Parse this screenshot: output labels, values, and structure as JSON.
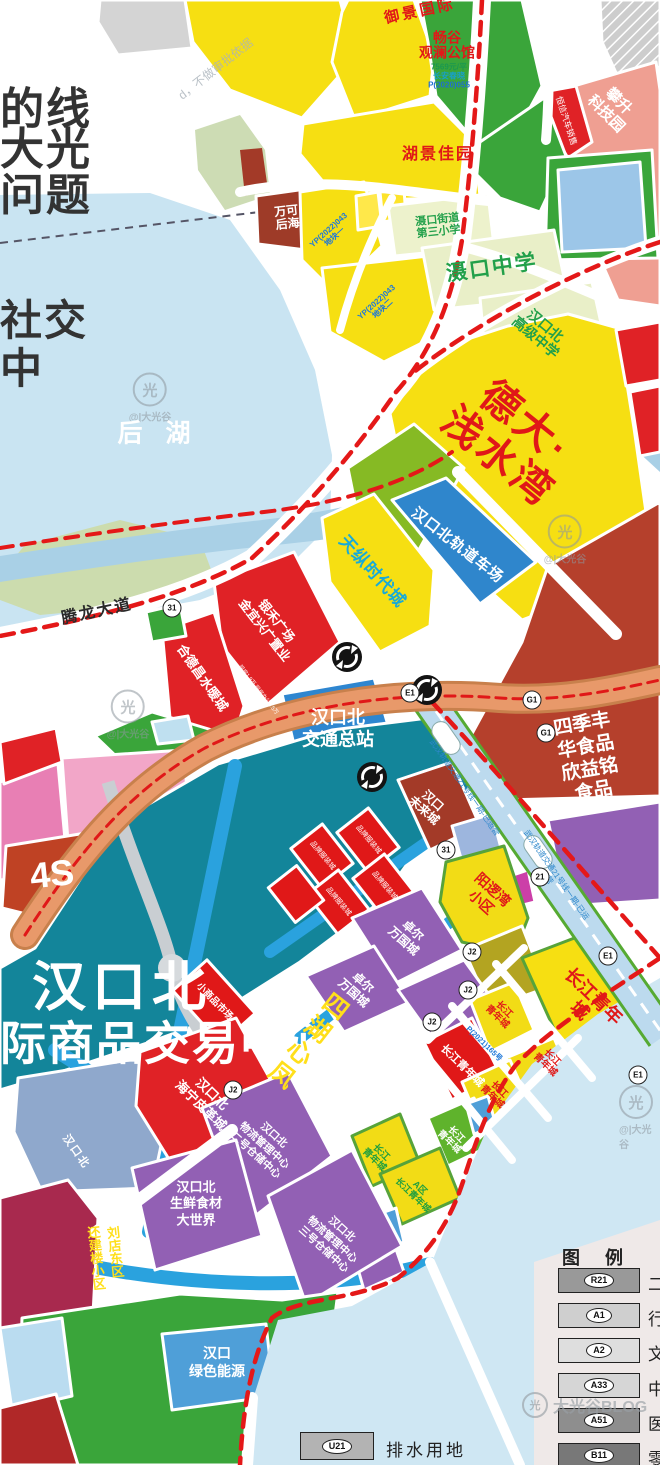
{
  "page": {
    "title": "汉口北规划图",
    "width": 660,
    "height": 1465
  },
  "overlay": {
    "l1": "的线",
    "l2": "大光",
    "l3": "问题",
    "l4": "社交",
    "l5": "中",
    "diag": "d，不做审批依据"
  },
  "watermark": {
    "logo": "@|大光谷",
    "blog": "大光谷BLOG",
    "logo_char": "光"
  },
  "palette": {
    "boundary_red": "#e41818",
    "water_lake": "#c9e4f2",
    "river": "#a9d0e6",
    "market_teal": "#13859a",
    "road_blue": "#2aa2de",
    "parcel_yellow": "#f6df12",
    "parcel_purple": "#9260b4",
    "parcel_red": "#e02226",
    "parcel_green": "#3aa53a",
    "expressway_tan": "#e8996a",
    "rail_band": "#bcdaee",
    "label_red": "#e01818",
    "label_green": "#22a04a",
    "label_blue": "#1f78d8",
    "dark_red": "#b5402c"
  },
  "map": {
    "labels": [
      {
        "name": "yujing-label",
        "text": "御景国际",
        "x": 420,
        "y": 12,
        "rot": -12,
        "fs": 15,
        "color": "#e01818",
        "w": 900,
        "ls": 3
      },
      {
        "name": "changgu-label",
        "text": "畅谷\n观澜公馆",
        "x": 447,
        "y": 46,
        "rot": 0,
        "fs": 14,
        "color": "#e01818",
        "w": 900
      },
      {
        "name": "changgu-price",
        "text": "7569元/平",
        "x": 449,
        "y": 68,
        "rot": 0,
        "fs": 8,
        "color": "#1a9850",
        "w": 700
      },
      {
        "name": "changgu-dev",
        "text": "长安春晓",
        "x": 449,
        "y": 77,
        "rot": 0,
        "fs": 8,
        "color": "#18a0c8",
        "w": 700
      },
      {
        "name": "changgu-code",
        "text": "P(2020)055",
        "x": 449,
        "y": 86,
        "rot": 0,
        "fs": 8,
        "color": "#1f6fd0",
        "w": 700
      },
      {
        "name": "hujing-label",
        "text": "湖景佳园",
        "x": 438,
        "y": 155,
        "rot": 0,
        "fs": 16,
        "color": "#e01818",
        "w": 900,
        "ls": 2
      },
      {
        "name": "keji-label",
        "text": "攀升\n科技园",
        "x": 612,
        "y": 108,
        "rot": 45,
        "fs": 15,
        "color": "#ffffff",
        "w": 700,
        "lh": 1.2
      },
      {
        "name": "hengxin-label",
        "text": "恒信汽车销售",
        "x": 566,
        "y": 121,
        "rot": 72,
        "fs": 8.5,
        "color": "#ffffff",
        "w": 400
      },
      {
        "name": "wanke-label",
        "text": "万可\n后海",
        "x": 287,
        "y": 218,
        "rot": -6,
        "fs": 12,
        "color": "#ffffff",
        "w": 700
      },
      {
        "name": "yp1-label",
        "text": "YP(2022)043\n地块一",
        "x": 332,
        "y": 234,
        "rot": -42,
        "fs": 8,
        "color": "#1f78d8",
        "w": 700
      },
      {
        "name": "yp2-label",
        "text": "YP(2022)043\n地块二",
        "x": 380,
        "y": 306,
        "rot": -42,
        "fs": 8,
        "color": "#1f78d8",
        "w": 700
      },
      {
        "name": "xiaoxue-label",
        "text": "滠口街道\n第三小学",
        "x": 438,
        "y": 226,
        "rot": -6,
        "fs": 11,
        "color": "#22a04a",
        "w": 900
      },
      {
        "name": "zhongxue-label",
        "text": "滠口中学",
        "x": 492,
        "y": 268,
        "rot": -8,
        "fs": 21,
        "color": "#22a04a",
        "w": 900,
        "ls": 2
      },
      {
        "name": "gaozhong-label",
        "text": "汉口北\n高级中学",
        "x": 540,
        "y": 332,
        "rot": 40,
        "fs": 14,
        "color": "#22a04a",
        "w": 900
      },
      {
        "name": "deda-label",
        "text": "德大·浅水湾",
        "x": 512,
        "y": 440,
        "rot": 39,
        "fs": 40,
        "color": "#e01818",
        "w": 900,
        "ls": 4
      },
      {
        "name": "guidao-label",
        "text": "汉口北轨道车场",
        "x": 457,
        "y": 546,
        "rot": 38,
        "fs": 15,
        "color": "#ffffff",
        "w": 700,
        "ls": 1
      },
      {
        "name": "tianzong-label",
        "text": "天纵时代城",
        "x": 372,
        "y": 572,
        "rot": 48,
        "fs": 17,
        "color": "#18aad8",
        "w": 900,
        "ls": 1
      },
      {
        "name": "houhu-label",
        "text": "后 湖",
        "x": 158,
        "y": 434,
        "rot": 0,
        "fs": 25,
        "color": "#ffffff",
        "w": 700,
        "ls": 8
      },
      {
        "name": "tenglong-label",
        "text": "腾龙大道",
        "x": 97,
        "y": 612,
        "rot": -12,
        "fs": 16,
        "color": "#2a2a2a",
        "w": 700,
        "ls": 2
      },
      {
        "name": "yinhe-label",
        "text": "银禾广场\n金宜兴广置业",
        "x": 270,
        "y": 626,
        "rot": 52,
        "fs": 12.5,
        "color": "#ffffff",
        "w": 700,
        "lh": 1.2
      },
      {
        "name": "yinhe-sub",
        "text": "现房1.9万 现房办公1.5万",
        "x": 258,
        "y": 690,
        "rot": 52,
        "fs": 5.5,
        "color": "#ffffff",
        "w": 400
      },
      {
        "name": "hedechang-label",
        "text": "合德昌水暖城",
        "x": 202,
        "y": 678,
        "rot": 55,
        "fs": 13,
        "color": "#ffffff",
        "w": 700
      },
      {
        "name": "jiaotong-label",
        "text": "汉口北\n交通总站",
        "x": 338,
        "y": 729,
        "rot": 0,
        "fs": 18,
        "color": "#ffffff",
        "w": 900,
        "lh": 1.2
      },
      {
        "name": "siji-label",
        "text": "四季丰华食品\n欣益铭食品",
        "x": 588,
        "y": 759,
        "rot": -10,
        "fs": 19,
        "color": "#ffffff",
        "w": 900,
        "lh": 1.2
      },
      {
        "name": "weilai-label",
        "text": "汉口\n未来城",
        "x": 428,
        "y": 806,
        "rot": 42,
        "fs": 12,
        "color": "#ffffff",
        "w": 700
      },
      {
        "name": "fours-label",
        "text": "4S",
        "x": 52,
        "y": 874,
        "rot": -6,
        "fs": 36,
        "color": "#ffffff",
        "w": 900
      },
      {
        "name": "hk-title-main",
        "text": "汉口北",
        "x": 122,
        "y": 988,
        "rot": 0,
        "fs": 54,
        "color": "#ffffff",
        "w": 900,
        "ls": 6
      },
      {
        "name": "hk-title-sub",
        "text": "际商品交易中心",
        "x": 168,
        "y": 1044,
        "rot": 0,
        "fs": 46,
        "color": "#ffffff",
        "w": 900,
        "ls": 2
      },
      {
        "name": "hall-label-1",
        "text": "品牌服装城",
        "x": 322,
        "y": 856,
        "rot": 50,
        "fs": 7,
        "color": "#ffffff",
        "w": 400
      },
      {
        "name": "hall-label-2",
        "text": "品牌服装城",
        "x": 368,
        "y": 840,
        "rot": 50,
        "fs": 7,
        "color": "#ffffff",
        "w": 400
      },
      {
        "name": "hall-label-3",
        "text": "品牌服装城",
        "x": 338,
        "y": 902,
        "rot": 50,
        "fs": 7,
        "color": "#ffffff",
        "w": 400
      },
      {
        "name": "hall-label-4",
        "text": "品牌服装城",
        "x": 384,
        "y": 886,
        "rot": 50,
        "fs": 7,
        "color": "#ffffff",
        "w": 400
      },
      {
        "name": "xiaoshangpin-label",
        "text": "小商品市场",
        "x": 214,
        "y": 1002,
        "rot": 46,
        "fs": 9.5,
        "color": "#ffffff",
        "w": 700
      },
      {
        "name": "pigecheng-label",
        "text": "汉口北\n海宁皮革城",
        "x": 206,
        "y": 1100,
        "rot": 44,
        "fs": 13,
        "color": "#ffffff",
        "w": 700,
        "lh": 1.25
      },
      {
        "name": "hkb-left-label",
        "text": "汉口北",
        "x": 76,
        "y": 1152,
        "rot": 55,
        "fs": 11,
        "color": "#ffffff",
        "w": 700,
        "ls": 2
      },
      {
        "name": "wuliu2-label",
        "text": "汉口北\n物流管理中心\n二号仓储中心",
        "x": 264,
        "y": 1146,
        "rot": 42,
        "fs": 10.5,
        "color": "#ffffff",
        "w": 700,
        "lh": 1.3
      },
      {
        "name": "wuliu3-label",
        "text": "汉口北\n物流管理中心\n三号仓储中心",
        "x": 332,
        "y": 1240,
        "rot": 42,
        "fs": 10.5,
        "color": "#ffffff",
        "w": 700,
        "lh": 1.3
      },
      {
        "name": "shengxian-label",
        "text": "汉口北\n生鲜食材\n大世界",
        "x": 196,
        "y": 1204,
        "rot": 0,
        "fs": 13,
        "color": "#ffffff",
        "w": 900,
        "lh": 1.25
      },
      {
        "name": "liudian-label-1",
        "text": "刘店东区",
        "x": 114,
        "y": 1252,
        "rot": -6,
        "fs": 13,
        "color": "#ffdf1a",
        "w": 900,
        "vert": true
      },
      {
        "name": "liudian-label-2",
        "text": "还建楼小区",
        "x": 95,
        "y": 1258,
        "rot": -6,
        "fs": 13,
        "color": "#ffdf1a",
        "w": 900,
        "vert": true
      },
      {
        "name": "lvse-label",
        "text": "汉口\n绿色能源",
        "x": 217,
        "y": 1362,
        "rot": 0,
        "fs": 14,
        "color": "#ffffff",
        "w": 700,
        "lh": 1.3
      },
      {
        "name": "yangluo-label",
        "text": "阳逻湾\n小区",
        "x": 487,
        "y": 896,
        "rot": 42,
        "fs": 14,
        "color": "#e01818",
        "w": 900,
        "lh": 1.2
      },
      {
        "name": "zhuoer-label-1",
        "text": "卓尔\n万国城",
        "x": 408,
        "y": 936,
        "rot": 42,
        "fs": 12,
        "color": "#ffffff",
        "w": 700,
        "lh": 1.2
      },
      {
        "name": "zhuoer-label-2",
        "text": "卓尔\n万国城",
        "x": 358,
        "y": 988,
        "rot": 42,
        "fs": 12,
        "color": "#ffffff",
        "w": 700,
        "lh": 1.2
      },
      {
        "name": "fenghuang-band-label",
        "text": "四湖心凤",
        "x": 306,
        "y": 1040,
        "rot": 38,
        "fs": 25,
        "color": "#ffdf1a",
        "w": 900,
        "ls": 4,
        "vert": true
      },
      {
        "name": "cj-big-label",
        "text": "长江青年城",
        "x": 586,
        "y": 1004,
        "rot": 44,
        "fs": 18,
        "color": "#e01818",
        "w": 900
      },
      {
        "name": "cj-label-red",
        "text": "长江青年城",
        "x": 462,
        "y": 1066,
        "rot": 44,
        "fs": 11,
        "color": "#ffffff",
        "w": 700
      },
      {
        "name": "cj-label-y1",
        "text": "长江\n青年城",
        "x": 500,
        "y": 1014,
        "rot": 44,
        "fs": 9.5,
        "color": "#e01818",
        "w": 700
      },
      {
        "name": "cj-label-y2",
        "text": "长江\n青年城",
        "x": 548,
        "y": 1062,
        "rot": 44,
        "fs": 9.5,
        "color": "#e01818",
        "w": 700
      },
      {
        "name": "cj-label-y3",
        "text": "长江\n青年城",
        "x": 495,
        "y": 1094,
        "rot": 44,
        "fs": 9.5,
        "color": "#e01818",
        "w": 700
      },
      {
        "name": "cj-label-g1",
        "text": "长江\n青年城",
        "x": 452,
        "y": 1139,
        "rot": 44,
        "fs": 9.5,
        "color": "#ffffff",
        "w": 700
      },
      {
        "name": "cj-label-y4",
        "text": "长江\n青年城",
        "x": 377,
        "y": 1157,
        "rot": 44,
        "fs": 9.5,
        "color": "#1f9f3f",
        "w": 700
      },
      {
        "name": "cj-label-ac",
        "text": "A区\n长江青年城",
        "x": 416,
        "y": 1192,
        "rot": 44,
        "fs": 9,
        "color": "#1f9f3f",
        "w": 700
      },
      {
        "name": "p2021-label",
        "text": "P(2021)165号",
        "x": 484,
        "y": 1044,
        "rot": 44,
        "fs": 7.5,
        "color": "#1f78d8",
        "w": 700
      },
      {
        "name": "rail-text-1",
        "text": "武汉轨道交通21号线一期-已运营",
        "x": 464,
        "y": 788,
        "rot": 55,
        "fs": 8,
        "color": "#2f88cc",
        "w": 400
      },
      {
        "name": "rail-text-2",
        "text": "武汉轨道交通21号线一期-已运营",
        "x": 552,
        "y": 878,
        "rot": 55,
        "fs": 8,
        "color": "#2f88cc",
        "w": 400
      }
    ],
    "badges": [
      {
        "t": "G1",
        "x": 532,
        "y": 700
      },
      {
        "t": "G1",
        "x": 546,
        "y": 733
      },
      {
        "t": "E1",
        "x": 410,
        "y": 693
      },
      {
        "t": "31",
        "x": 172,
        "y": 608
      },
      {
        "t": "31",
        "x": 446,
        "y": 850
      },
      {
        "t": "21",
        "x": 540,
        "y": 877
      },
      {
        "t": "J2",
        "x": 472,
        "y": 952
      },
      {
        "t": "J2",
        "x": 468,
        "y": 990
      },
      {
        "t": "J2",
        "x": 432,
        "y": 1022
      },
      {
        "t": "E1",
        "x": 608,
        "y": 956
      },
      {
        "t": "E1",
        "x": 638,
        "y": 1075
      },
      {
        "t": "J2",
        "x": 233,
        "y": 1090
      }
    ]
  },
  "legend": {
    "title": "图 例",
    "items": [
      {
        "code": "R21",
        "label": "二",
        "color": "#999999"
      },
      {
        "code": "A1",
        "label": "行",
        "color": "#cfcfcf"
      },
      {
        "code": "A2",
        "label": "文",
        "color": "#dedede"
      },
      {
        "code": "A33",
        "label": "中",
        "color": "#d6d6d6"
      },
      {
        "code": "A51",
        "label": "医",
        "color": "#8e8e8e"
      },
      {
        "code": "B11",
        "label": "零",
        "color": "#787878"
      }
    ],
    "drain": {
      "code": "U21",
      "label": "排水用地",
      "color": "#b3b3b3"
    }
  }
}
